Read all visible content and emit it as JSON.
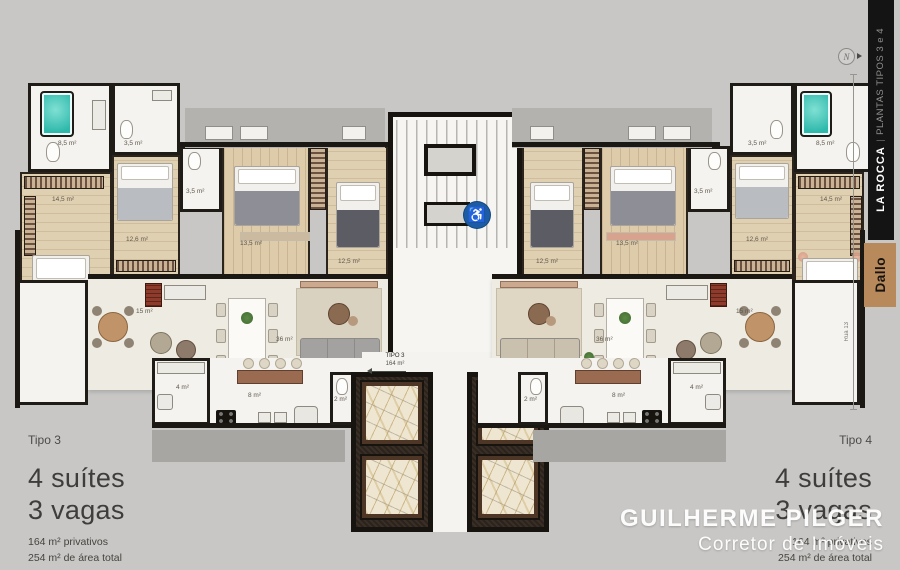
{
  "sidebar": {
    "brand": "LA ROCCA",
    "divider": "|",
    "subtitle": "PLANTAS TIPOS 3 e 4",
    "logo": "Dallo",
    "bar_color": "#141414",
    "logo_bg": "#b8895a"
  },
  "compass": {
    "label": "N"
  },
  "street": {
    "label": "Rua 13"
  },
  "units": {
    "left": {
      "tipo": "Tipo 3",
      "suites": "4 suítes",
      "vagas": "3 vagas",
      "privativos": "164 m² privativos",
      "total": "254 m² de área total"
    },
    "right": {
      "tipo": "Tipo 4",
      "suites": "4 suítes",
      "vagas": "3 vagas",
      "privativos": "164 m² privativos",
      "total": "254 m² de área total"
    }
  },
  "watermark": {
    "name": "GUILHERME PILGER",
    "role": "Corretor de Imóveis"
  },
  "plan": {
    "unit_tags": {
      "left_name": "TIPO 3",
      "left_area": "164 m²",
      "right_name": "TIPO 4",
      "right_area": "164 m²"
    },
    "accessibility_icon": "♿",
    "colors": {
      "accent_blue": "#1d5ca5",
      "tub_teal": "#2fb9ab",
      "marble": "#efe6d2"
    },
    "rooms_left": {
      "bath_master": "8,5 m²",
      "bath2": "3,5 m²",
      "suite1": "14,5 m²",
      "suite2": "12,6 m²",
      "suite3": "13,5 m²",
      "bath3": "3,5 m²",
      "suite4": "12,5 m²",
      "terrace": "15 m²",
      "living": "36 m²",
      "pantry": "4 m²",
      "kitchen": "8 m²",
      "lavabo": "2 m²"
    },
    "rooms_right": {
      "bath_master": "8,5 m²",
      "bath2": "3,5 m²",
      "suite1": "14,5 m²",
      "suite2": "12,6 m²",
      "suite3": "13,5 m²",
      "bath3": "3,5 m²",
      "suite4": "12,5 m²",
      "terrace": "15 m²",
      "living": "36 m²",
      "pantry": "4 m²",
      "kitchen": "8 m²",
      "lavabo": "2 m²"
    }
  }
}
